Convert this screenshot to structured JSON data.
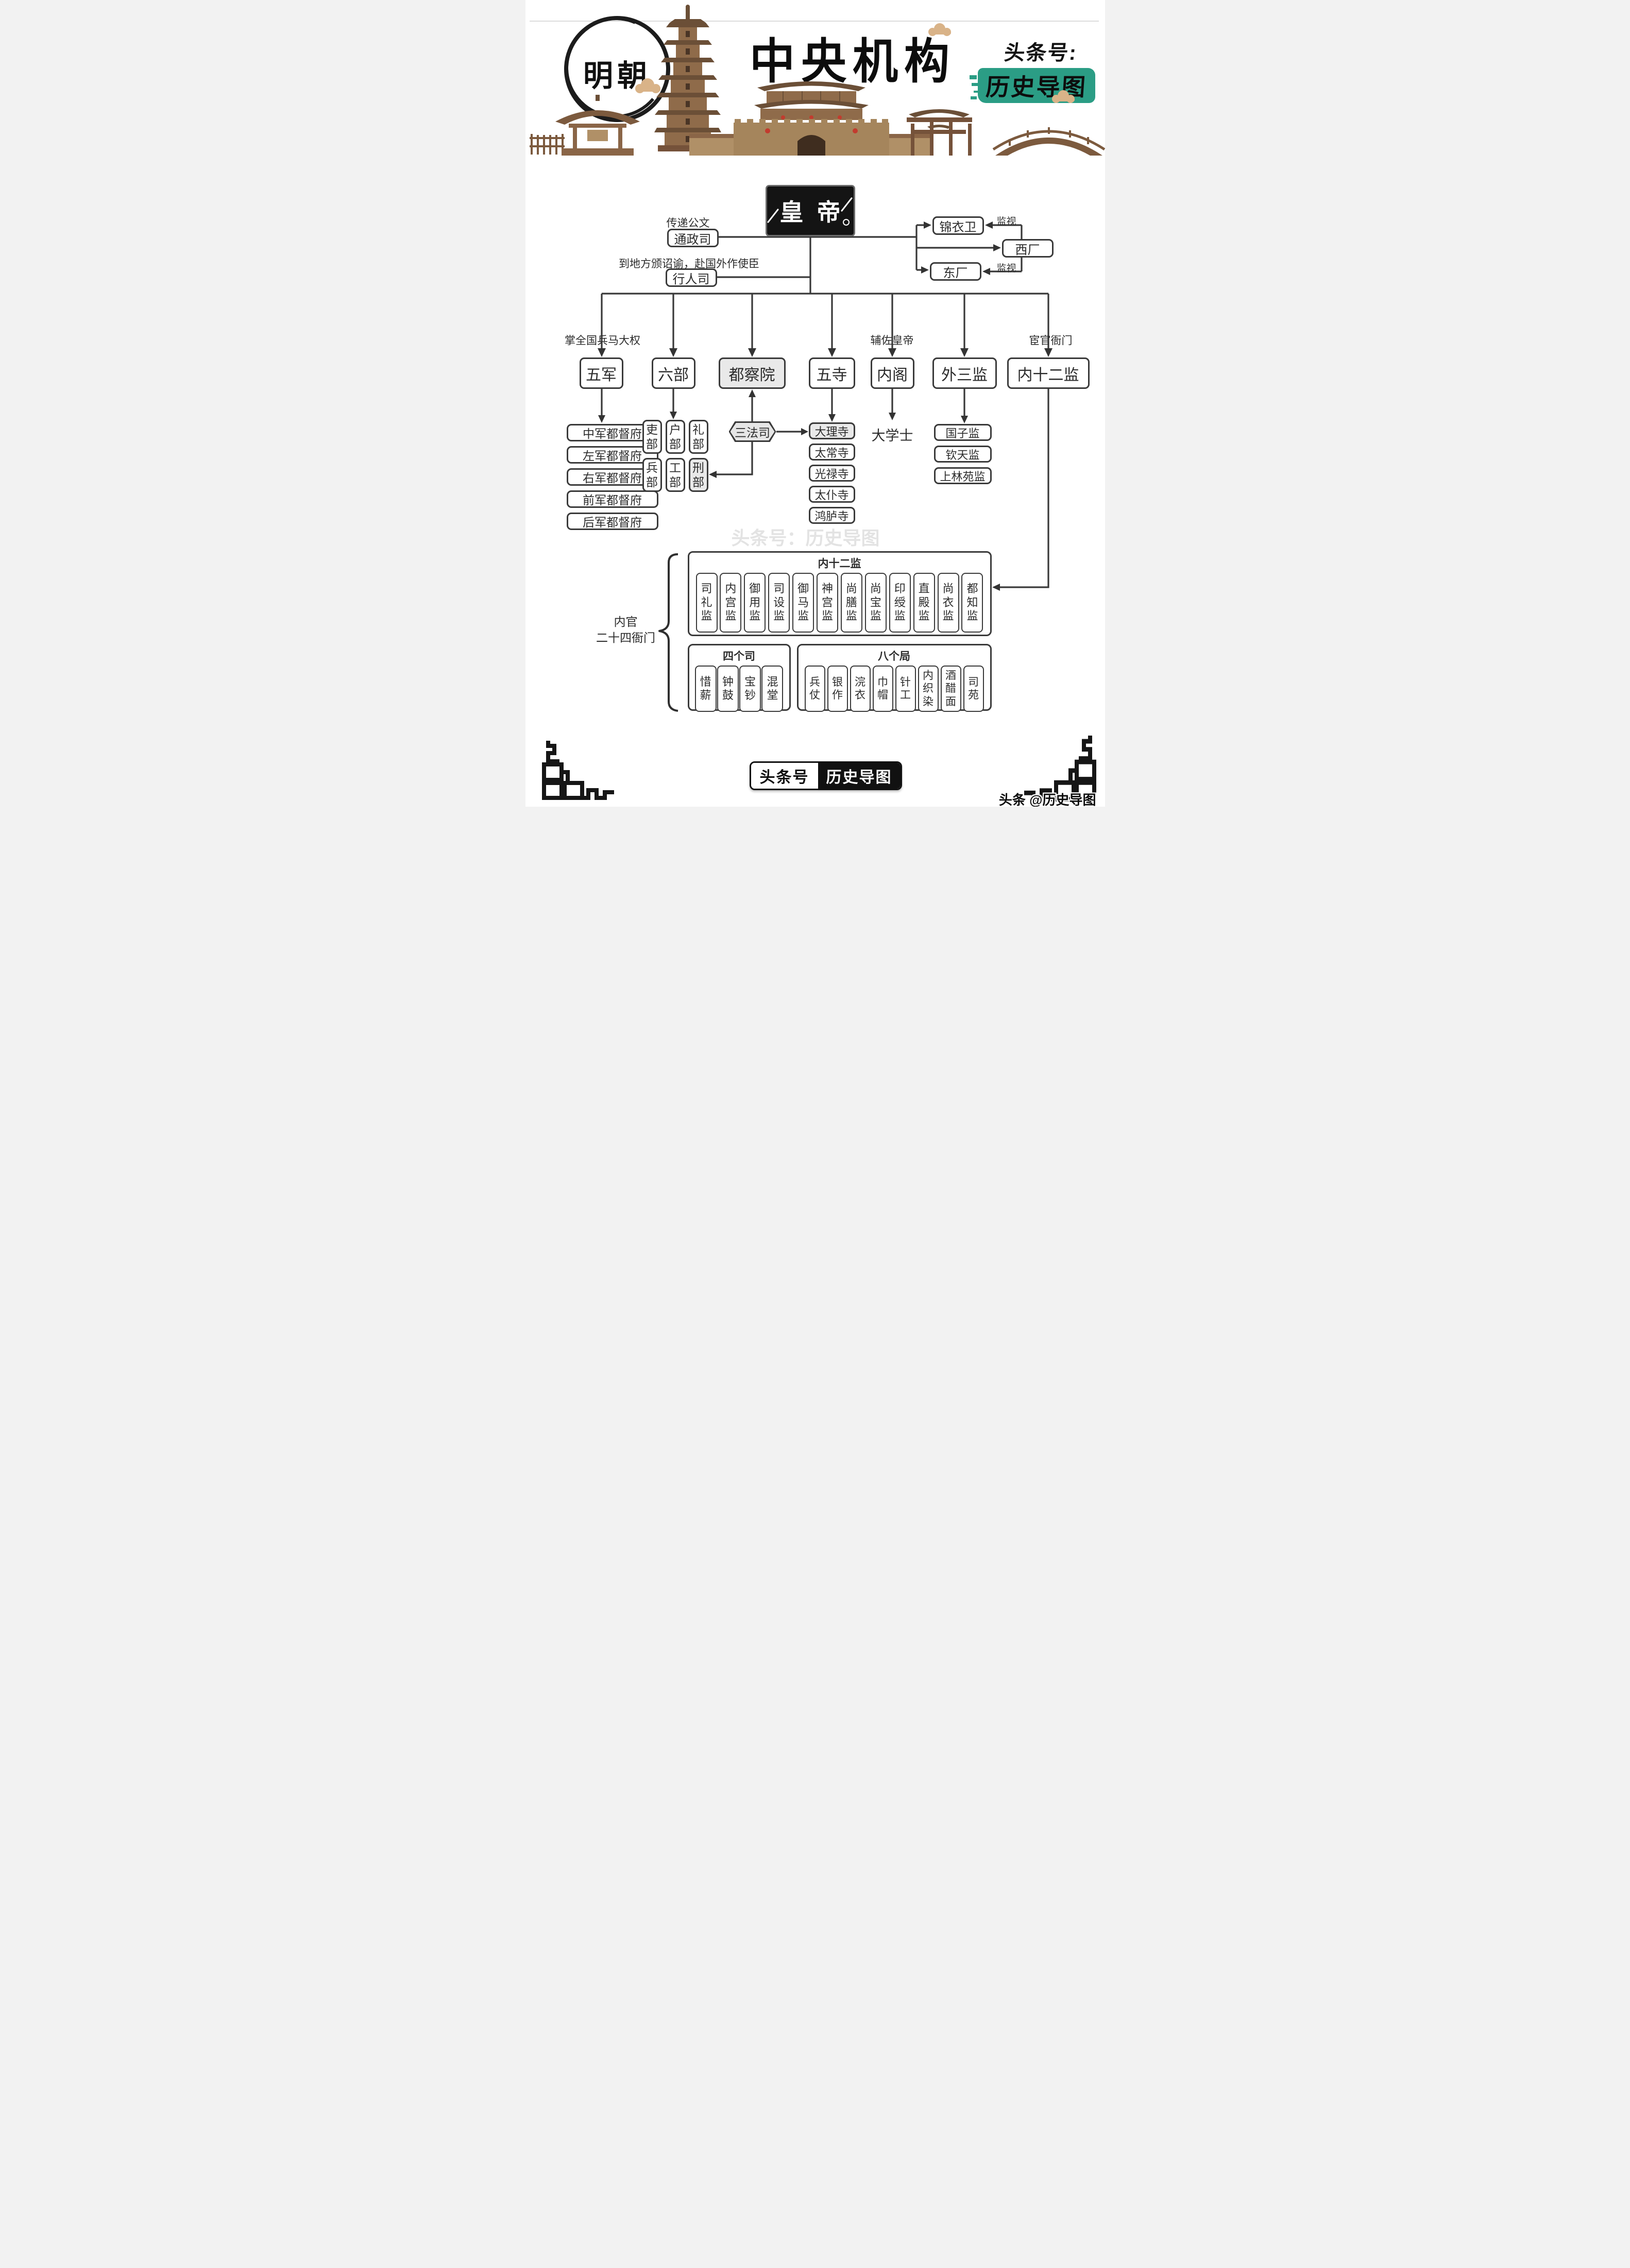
{
  "header": {
    "era_badge": "明朝",
    "title": "中央机构",
    "account_prefix": "头条号:",
    "account_name": "历史导图",
    "colors": {
      "accent_green": "#2b9d85",
      "illustration_brown": "#8a6547"
    }
  },
  "chart": {
    "emperor": "皇帝",
    "left_branch": {
      "tongzheng_note": "传递公文",
      "tongzheng": "通政司",
      "xingren_note": "到地方颁诏谕，赴国外作使臣",
      "xingren": "行人司"
    },
    "right_branch": {
      "jinyiwei": "锦衣卫",
      "xichang": "西厂",
      "dongchang": "东厂",
      "monitor_top": "监视",
      "monitor_bottom": "监视"
    },
    "main_row": {
      "wujun": {
        "label": "五军",
        "note": "掌全国兵马大权"
      },
      "liubu": {
        "label": "六部"
      },
      "duchayuan": {
        "label": "都察院"
      },
      "wusi": {
        "label": "五寺"
      },
      "neige": {
        "label": "内阁",
        "note": "辅佐皇帝"
      },
      "waisanjian": {
        "label": "外三监"
      },
      "neishierjian": {
        "label": "内十二监",
        "note": "宦官衙门"
      }
    },
    "wujun_children": [
      "中军都督府",
      "左军都督府",
      "右军都督府",
      "前军都督府",
      "后军都督府"
    ],
    "liubu_children": [
      "吏部",
      "户部",
      "礼部",
      "兵部",
      "工部",
      "刑部"
    ],
    "sanfasi": "三法司",
    "wusi_children": [
      "大理寺",
      "太常寺",
      "光禄寺",
      "太仆寺",
      "鸿胪寺"
    ],
    "neige_child": "大学士",
    "waisanjian_children": [
      "国子监",
      "钦天监",
      "上林苑监"
    ],
    "inner_twelve": {
      "title": "内十二监",
      "items": [
        "司礼监",
        "内宫监",
        "御用监",
        "司设监",
        "御马监",
        "神宫监",
        "尚膳监",
        "尚宝监",
        "印绶监",
        "直殿监",
        "尚衣监",
        "都知监"
      ]
    },
    "four_si": {
      "title": "四个司",
      "items": [
        "惜薪",
        "钟鼓",
        "宝钞",
        "混堂"
      ]
    },
    "eight_ju": {
      "title": "八个局",
      "items": [
        "兵仗",
        "银作",
        "浣衣",
        "巾帽",
        "针工",
        "内织染",
        "酒醋面",
        "司苑"
      ]
    },
    "bracket_label": {
      "line1": "内官",
      "line2": "二十四衙门"
    }
  },
  "watermarks": {
    "center": "头条号：历史导图",
    "bottom_right": "头条 @历史导图"
  },
  "footer_badge": {
    "left": "头条号",
    "right": "历史导图"
  }
}
